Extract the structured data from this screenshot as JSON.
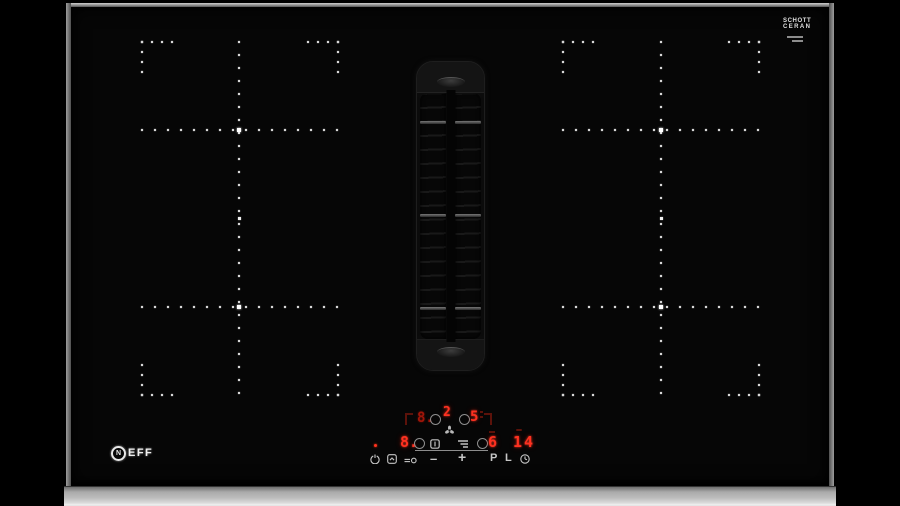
{
  "photo": {
    "background_color": "#000000"
  },
  "hob": {
    "brand": {
      "initial": "N",
      "rest": "EFF"
    },
    "glass_logo": {
      "line1": "SCHOTT",
      "line2": "CERAN"
    },
    "colors": {
      "led_red": "#ff3120",
      "led_red_dim": "#5c120a",
      "symbol_gray": "#c6c6c6",
      "frame_silver": "#bdbdbd",
      "zone_dot_white": "#d7d7d7"
    }
  },
  "controls": {
    "displays": {
      "back_left": "8.",
      "front_left": "8.",
      "fan": "2",
      "back_right": "5",
      "front_right": "6",
      "timer": "14"
    },
    "keys": {
      "minus": "–",
      "plus": "+",
      "power_boost": "P",
      "childlock": "L"
    },
    "icons": [
      "power-icon",
      "wipe-protection-icon",
      "connect-icon",
      "fan-icon",
      "vent-grid-icon",
      "airflow-icon",
      "clock-icon"
    ]
  },
  "zones_layout": {
    "y_top": 42,
    "y_bottom": 395,
    "cross_rows": [
      130,
      307
    ],
    "mid_y": 218,
    "dot_step": 13,
    "corner_step": 10,
    "corner_arm_dots": 4,
    "groups": [
      {
        "name": "left",
        "x1": 142,
        "x2": 338,
        "cx": 239
      },
      {
        "name": "right",
        "x1": 563,
        "x2": 759,
        "cx": 661
      }
    ]
  }
}
